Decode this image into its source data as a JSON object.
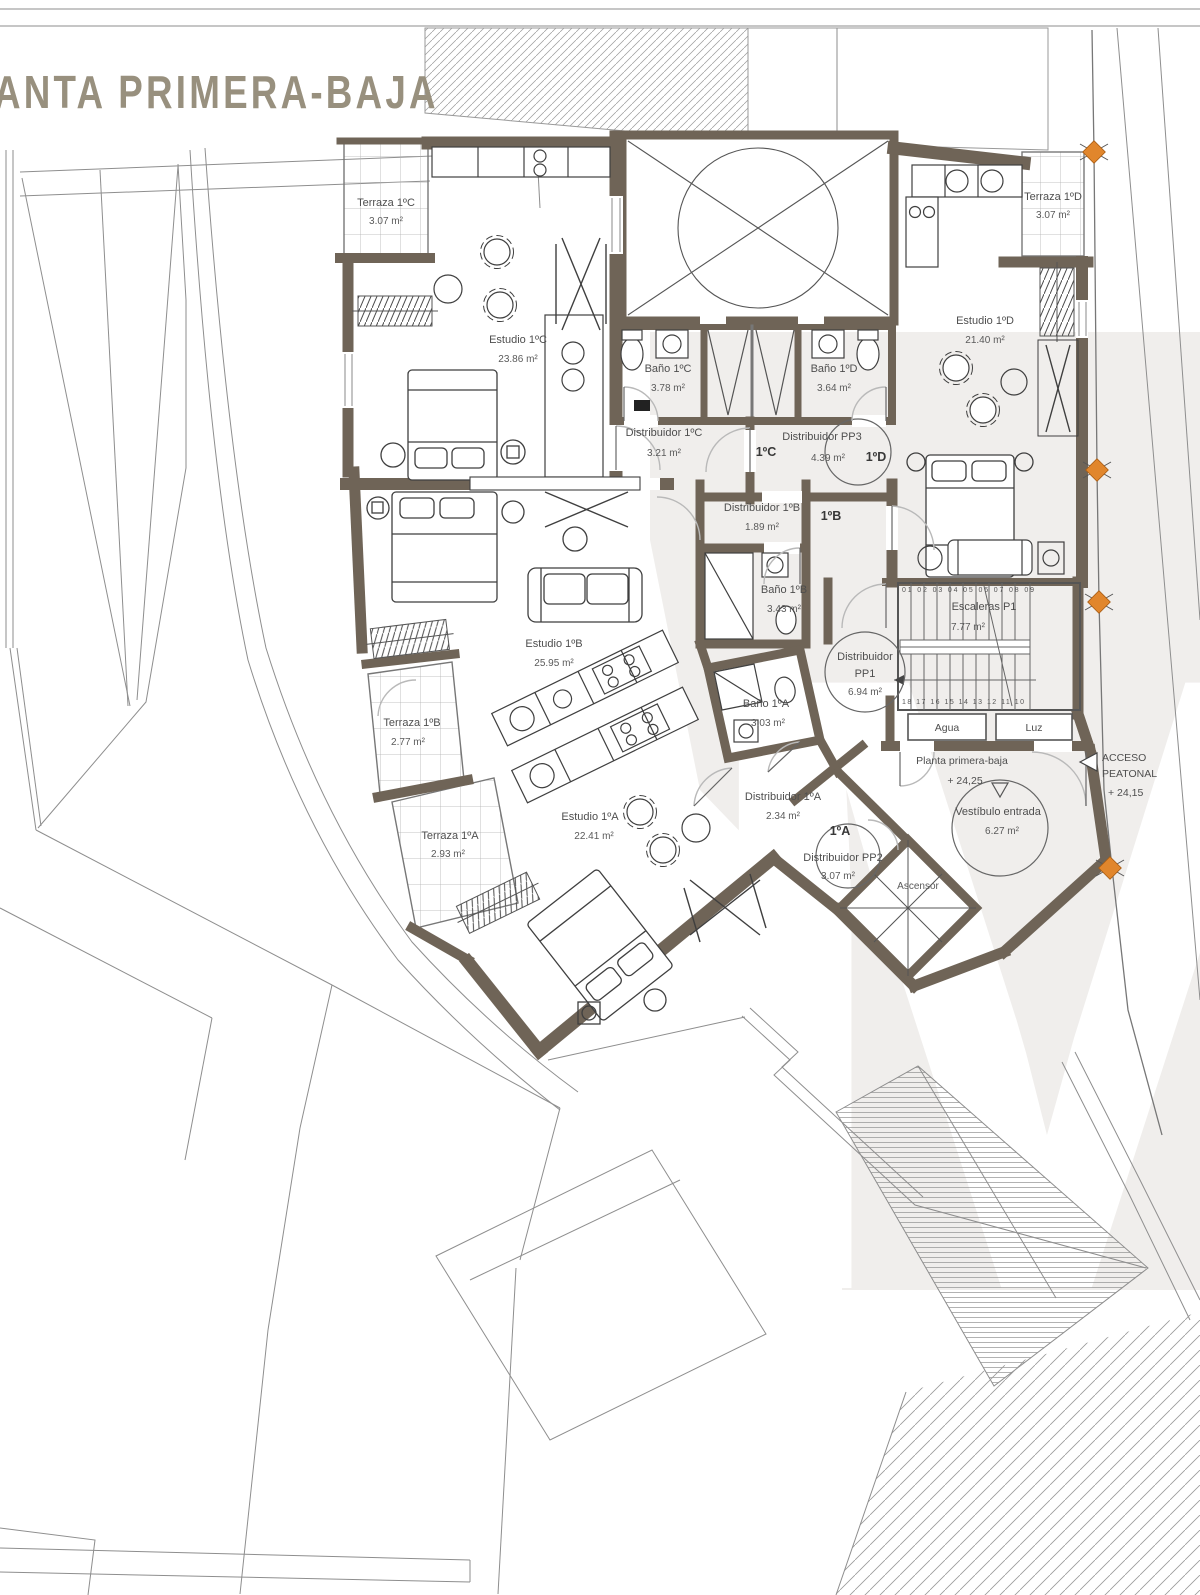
{
  "title": "ANTA PRIMERA-BAJA",
  "watermark": "M",
  "rooms": {
    "terraza_1c": {
      "name": "Terraza 1ºC",
      "area": "3.07 m²"
    },
    "estudio_1c": {
      "name": "Estudio 1ºC",
      "area": "23.86 m²"
    },
    "bano_1c": {
      "name": "Baño 1ºC",
      "area": "3.78 m²"
    },
    "bano_1d": {
      "name": "Baño 1ºD",
      "area": "3.64 m²"
    },
    "estudio_1d": {
      "name": "Estudio 1ºD",
      "area": "21.40 m²"
    },
    "terraza_1d": {
      "name": "Terraza 1ºD",
      "area": "3.07 m²"
    },
    "dist_1c": {
      "name": "Distribuidor 1ºC",
      "area": "3.21 m²"
    },
    "dist_pp3": {
      "name": "Distribuidor PP3",
      "area": "4.39 m²"
    },
    "dist_1b": {
      "name": "Distribuidor 1ºB",
      "area": "1.89 m²"
    },
    "bano_1b": {
      "name": "Baño 1ºB",
      "area": "3.43 m²"
    },
    "escaleras": {
      "name": "Escaleras P1",
      "area": "7.77 m²"
    },
    "dist_pp1": {
      "line1": "Distribuidor",
      "line2": "PP1",
      "area": "6.94 m²"
    },
    "estudio_1b": {
      "name": "Estudio 1ºB",
      "area": "25.95 m²"
    },
    "terraza_1b": {
      "name": "Terraza 1ºB",
      "area": "2.77 m²"
    },
    "bano_1a": {
      "name": "Baño 1ºA",
      "area": "3.03 m²"
    },
    "dist_1a": {
      "name": "Distribuidor 1ºA",
      "area": "2.34 m²"
    },
    "terraza_1a": {
      "name": "Terraza 1ºA",
      "area": "2.93 m²"
    },
    "estudio_1a": {
      "name": "Estudio 1ºA",
      "area": "22.41 m²"
    },
    "dist_pp2": {
      "name": "Distribuidor PP2",
      "area": "3.07 m²"
    },
    "ascensor": {
      "name": "Ascensor"
    },
    "vestibulo": {
      "name": "Vestíbulo entrada",
      "area": "6.27 m²"
    }
  },
  "unit_tags": {
    "a": "1ºA",
    "b": "1ºB",
    "c": "1ºC",
    "d": "1ºD"
  },
  "stairs": {
    "top_numbers": "01 02 03 04 05 06 07 08 09",
    "bottom_numbers": "18 17 16 15 14 13 12 11 10"
  },
  "utilities": {
    "agua": "Agua",
    "luz": "Luz"
  },
  "level": {
    "name": "Planta primera-baja",
    "elevation": "+ 24,25"
  },
  "access": {
    "line1": "ACCESO",
    "line2": "PEATONAL",
    "elevation": "+ 24,15"
  },
  "colors": {
    "wall": "#6f6457",
    "marker": "#e1862c",
    "title": "#98907e",
    "thin_line": "#8e8e8e",
    "label": "#4e4e4e",
    "watermark_band": "#f0eeec"
  }
}
